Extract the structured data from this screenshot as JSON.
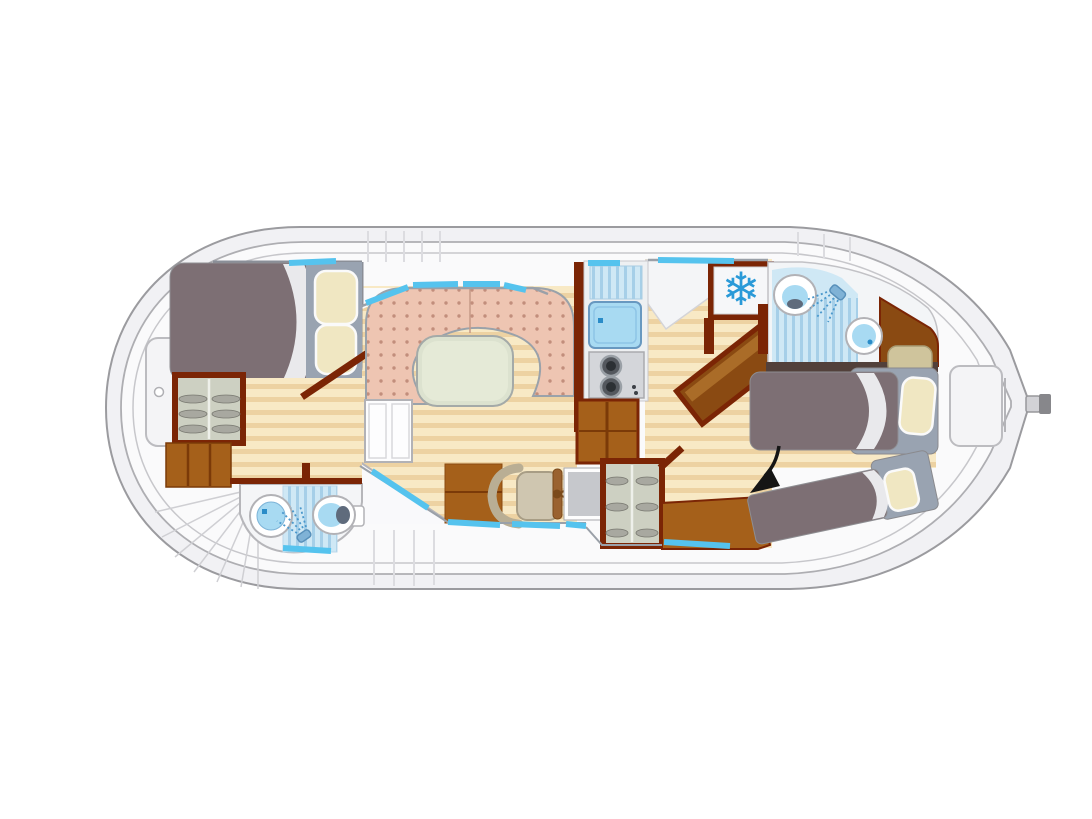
{
  "plan": {
    "type": "boat-floor-plan",
    "orientation": "bow-left-stern-right",
    "areas": [
      {
        "name": "bow-deck",
        "features": [
          "deck-hatch",
          "radial-bow-steps"
        ]
      },
      {
        "name": "front-cabin",
        "features": [
          "double-bed",
          "two-pillows",
          "folded-sheet",
          "wardrobe",
          "drawer-unit",
          "door-diagonal"
        ]
      },
      {
        "name": "front-bathroom",
        "features": [
          "washbasin",
          "shower",
          "toilet"
        ]
      },
      {
        "name": "saloon",
        "features": [
          "u-shaped-sofa",
          "dining-table",
          "white-cabinet",
          "storage-cabinet"
        ]
      },
      {
        "name": "helm-station",
        "features": [
          "helm-seat",
          "steering-wheel",
          "instrument-panel"
        ]
      },
      {
        "name": "galley",
        "features": [
          "draining-board",
          "sink",
          "two-burner-stove",
          "companionway-steps",
          "wardrobe"
        ]
      },
      {
        "name": "refrigerator",
        "features": [
          "snowflake-symbol"
        ]
      },
      {
        "name": "rear-bathroom",
        "features": [
          "toilet",
          "shower",
          "washbasin",
          "vanity-counter",
          "beige-seat"
        ]
      },
      {
        "name": "rear-cabin",
        "features": [
          "single-bed",
          "diagonal-single-bed",
          "bench-seat",
          "folded-table-diagonal",
          "access-arrow"
        ]
      },
      {
        "name": "stern-deck",
        "features": [
          "deck-hatch",
          "tiller-rudder"
        ]
      }
    ]
  },
  "icons": {
    "snowflake_glyph": "❄",
    "snowflake_meaning": "refrigerator-freezer",
    "arrow_meaning": "points-to-diagonal-berth",
    "showerhead_meaning": "shower"
  },
  "colors": {
    "page_bg": "#ffffff",
    "hull_fill": "#f1f1f4",
    "hull_stroke": "#9b9b9f",
    "deck_fill": "#fafafb",
    "gunwale_line": "#c7c7cb",
    "wood_light": "#f8e9c5",
    "wood_dark": "#edd2a2",
    "wall_red": "#7b2505",
    "furniture_brown": "#a5601a",
    "furniture_brown_dark": "#8a4a12",
    "blanket": "#7d6f74",
    "headboard": "#99a3b1",
    "pillow": "#f0e7c2",
    "sheet": "#e9e9ec",
    "sofa": "#eec5b2",
    "sofa_dot": "#c28e7c",
    "table": "#dce2cf",
    "table_inner": "#e5ead7",
    "window": "#55c3ee",
    "water": "#a8daf2",
    "shower_light": "#cfe8f5",
    "shower_stripe": "#a6cfe8",
    "snowflake": "#2a9ad8",
    "stove": "#d4d6da",
    "burner": "#54585e",
    "chair": "#cfc6b0",
    "wardrobe_fill": "#cdd0c2",
    "seat_beige": "#cfc49c",
    "arrow": "#151515"
  }
}
